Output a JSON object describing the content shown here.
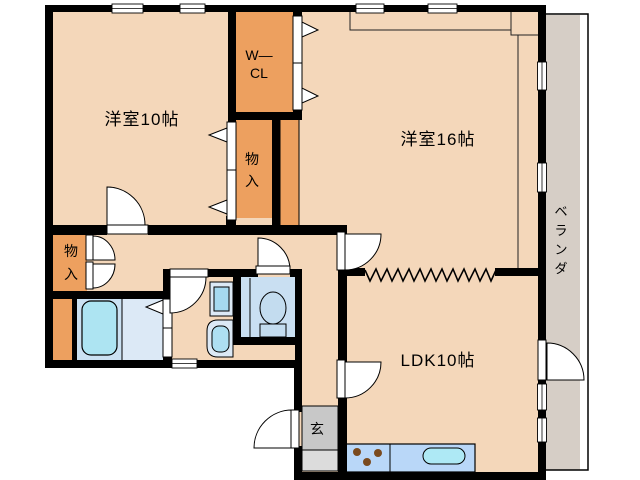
{
  "plan": {
    "type": "apartment-floor-plan",
    "colors": {
      "floor": "#F4D7BA",
      "closet": "#EDA05F",
      "wall": "#000000",
      "veranda": "#D6CEC6",
      "bath": "#CBE1F2",
      "bath_light": "#DCE9F6",
      "tub": "#ADE4F2",
      "toilet_floor": "#C9DFF2",
      "fixture": "#C3DCEF",
      "kitchen_counter": "#B9D7F8",
      "sink": "#AEE9F5",
      "entrance_upper": "#C8C8C8",
      "entrance_lower": "#DCDCDC",
      "burner": "#7A4A1E"
    },
    "rooms": {
      "bedroom1": {
        "label": "洋室10帖"
      },
      "bedroom2": {
        "label": "洋室16帖"
      },
      "ldk": {
        "label": "LDK10帖"
      },
      "walk_in_closet": {
        "line1": "W—",
        "line2": "CL"
      },
      "storage_center": {
        "char1": "物",
        "char2": "入"
      },
      "storage_hall": {
        "char1": "物",
        "char2": "入"
      },
      "entrance": {
        "label": "玄"
      },
      "veranda": {
        "char1": "ベ",
        "char2": "ラ",
        "char3": "ン",
        "char4": "ダ"
      }
    }
  }
}
